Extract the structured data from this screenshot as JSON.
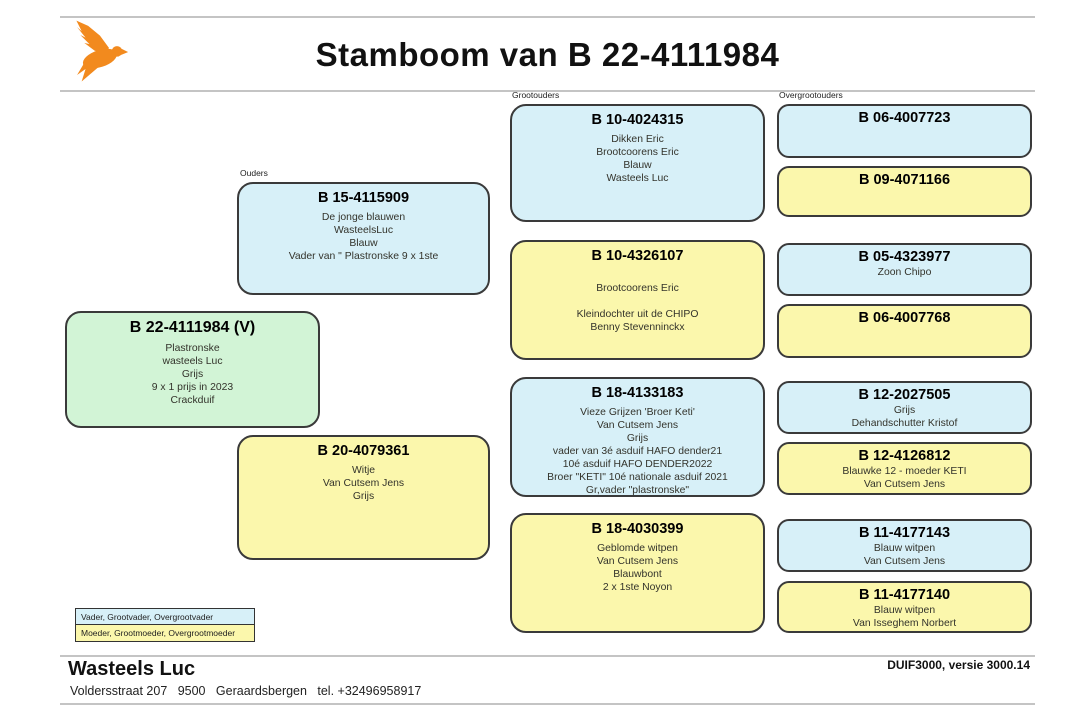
{
  "title": "Stamboom van B 22-4111984",
  "logo": {
    "icon": "flying-pigeon-icon",
    "color": "#F28A1E"
  },
  "column_labels": {
    "parents": "Ouders",
    "grandparents": "Grootouders",
    "great_grandparents": "Overgrootouders"
  },
  "colors": {
    "male_box": "#D7F0F8",
    "female_box": "#FBF7AC",
    "subject_box": "#D2F4D6",
    "box_border": "#3A3A3A",
    "logo_orange": "#F28A1E"
  },
  "subject": {
    "ring": "B 22-4111984 (V)",
    "lines": [
      "Plastronske",
      "wasteels Luc",
      "Grijs",
      "9 x 1 prijs in 2023",
      "Crackduif"
    ]
  },
  "father": {
    "ring": "B 15-4115909",
    "lines": [
      "De jonge blauwen",
      "WasteelsLuc",
      "Blauw",
      "Vader van \" Plastronske 9 x 1ste"
    ]
  },
  "mother": {
    "ring": "B 20-4079361",
    "lines": [
      "Witje",
      "Van Cutsem Jens",
      "Grijs"
    ]
  },
  "grandparents": [
    {
      "ring": "B 10-4024315",
      "lines": [
        "Dikken Eric",
        "Brootcoorens Eric",
        "Blauw",
        "Wasteels Luc"
      ]
    },
    {
      "ring": "B 10-4326107",
      "lines": [
        "",
        "Brootcoorens Eric",
        "",
        "Kleindochter uit de CHIPO",
        "Benny Stevenninckx"
      ]
    },
    {
      "ring": "B 18-4133183",
      "lines": [
        "Vieze Grijzen 'Broer Keti'",
        "Van Cutsem Jens",
        "Grijs",
        "vader van 3é asduif HAFO dender21",
        "10é asduif HAFO DENDER2022",
        "Broer \"KETI\" 10é nationale asduif 2021",
        "Gr,vader \"plastronske\""
      ]
    },
    {
      "ring": "B 18-4030399",
      "lines": [
        "Geblomde witpen",
        "Van Cutsem Jens",
        "Blauwbont",
        "2 x 1ste Noyon"
      ]
    }
  ],
  "great_grandparents": [
    {
      "ring": "B 06-4007723",
      "lines": []
    },
    {
      "ring": "B 09-4071166",
      "lines": []
    },
    {
      "ring": "B 05-4323977",
      "lines": [
        "Zoon Chipo"
      ]
    },
    {
      "ring": "B 06-4007768",
      "lines": []
    },
    {
      "ring": "B 12-2027505",
      "lines": [
        "Grijs",
        "Dehandschutter Kristof"
      ]
    },
    {
      "ring": "B 12-4126812",
      "lines": [
        "Blauwke 12 - moeder KETI",
        "Van Cutsem Jens"
      ]
    },
    {
      "ring": "B 11-4177143",
      "lines": [
        "Blauw witpen",
        "Van Cutsem Jens"
      ]
    },
    {
      "ring": "B 11-4177140",
      "lines": [
        "Blauw witpen",
        "Van Isseghem Norbert"
      ]
    }
  ],
  "legend": {
    "male": "Vader, Grootvader, Overgrootvader",
    "female": "Moeder, Grootmoeder, Overgrootmoeder"
  },
  "footer": {
    "owner": "Wasteels Luc",
    "address": "Voldersstraat 207   9500   Geraardsbergen   tel. +32496958917",
    "software": "DUIF3000, versie 3000.14"
  }
}
